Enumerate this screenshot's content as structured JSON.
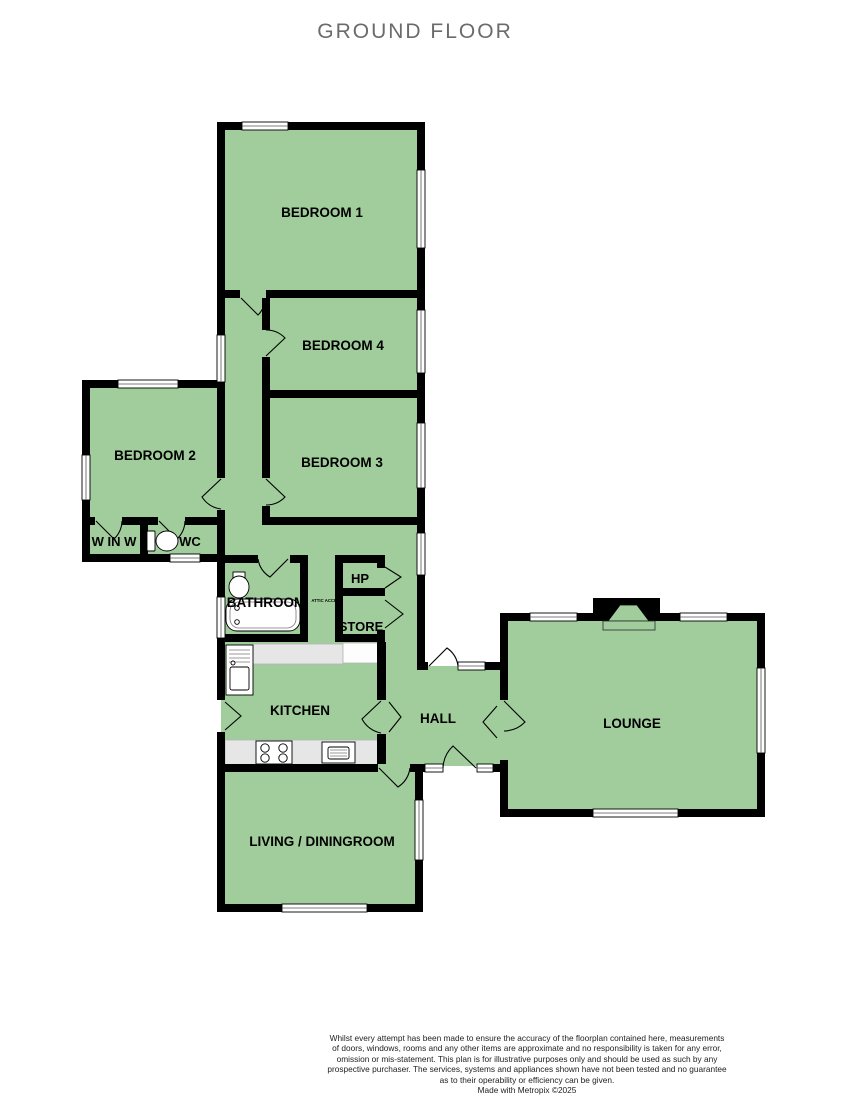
{
  "title": "GROUND FLOOR",
  "rooms": {
    "bedroom1": "BEDROOM 1",
    "bedroom2": "BEDROOM 2",
    "bedroom3": "BEDROOM 3",
    "bedroom4": "BEDROOM 4",
    "winw": "W IN W",
    "wc": "WC",
    "bathroom": "BATHROOM",
    "attic": "ATTIC ACCESS",
    "hp": "HP",
    "store": "STORE",
    "kitchen": "KITCHEN",
    "hall": "HALL",
    "lounge": "LOUNGE",
    "living_dining": "LIVING / DININGROOM"
  },
  "colors": {
    "room_fill": "#a0cd9b",
    "wall": "#000000",
    "counter": "#e6e6e6",
    "title_text": "#6b6b6b"
  },
  "footer": {
    "lines": [
      "Whilst every attempt has been made to ensure the accuracy of the floorplan contained here, measurements",
      "of doors, windows, rooms and any other items are approximate and no responsibility is taken for any error,",
      "omission or mis-statement. This plan is for illustrative purposes only and should be used as such by any",
      "prospective purchaser. The services, systems and appliances shown have not been tested and no guarantee",
      "as to their operability or efficiency can be given.",
      "Made with Metropix ©2025"
    ]
  }
}
